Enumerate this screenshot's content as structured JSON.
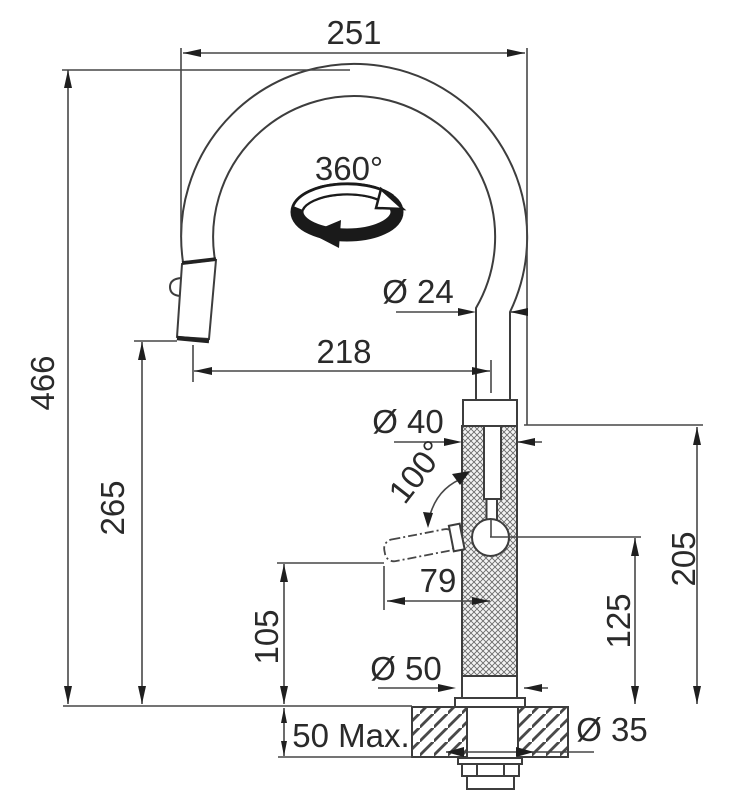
{
  "drawing": {
    "kind": "faucet-installation-dimension-drawing",
    "labels": {
      "width_overall": "251",
      "swivel_angle": "360°",
      "spout_tube_diameter": "Ø 24",
      "spout_reach": "218",
      "height_overall": "466",
      "spout_outlet_height": "265",
      "body_diameter": "Ø 40",
      "lever_angle": "100°",
      "lever_length": "79",
      "body_top_height": "205",
      "lever_pivot_height": "125",
      "lever_clearance_height": "105",
      "base_diameter": "Ø 50",
      "deck_thickness_max": "50 Max.",
      "mounting_hole_diameter": "Ø 35"
    },
    "colors": {
      "background": "#ffffff",
      "line": "#474747",
      "text": "#2a2a2a",
      "arrow": "#1f1f1f"
    }
  }
}
